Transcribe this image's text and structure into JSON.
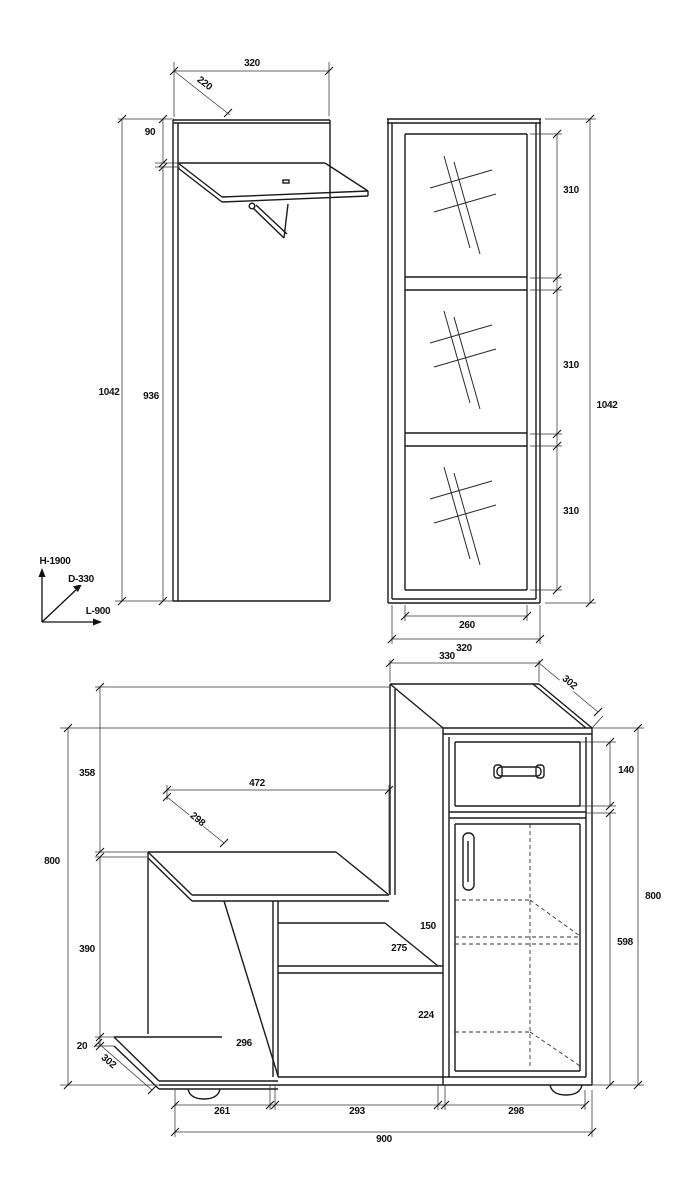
{
  "drawing": {
    "panel_view": {
      "width": "320",
      "depth": "220",
      "top_offset": "90",
      "total_height": "1042",
      "body_height": "936"
    },
    "wardrobe_view": {
      "mirror_top": "310",
      "mirror_mid": "310",
      "mirror_bottom": "310",
      "total_height": "1042",
      "inner_width": "260",
      "total_width": "320"
    },
    "axes": {
      "height": "H-1900",
      "depth": "D-330",
      "length": "L-900"
    },
    "cabinet_view": {
      "top_width": "330",
      "top_depth": "302",
      "drawer_height": "140",
      "right_height": "800",
      "door_height": "598",
      "left_upper": "358",
      "left_height": "800",
      "bench_width": "472",
      "bench_depth": "298",
      "left_lower": "390",
      "plinth_thickness": "20",
      "plinth_depth": "302",
      "side_panel_depth": "296",
      "shelf_clearance": "150",
      "shelf_depth": "275",
      "bottom_clearance": "224",
      "bay_left": "261",
      "bay_middle": "293",
      "bay_right": "298",
      "total_width": "900"
    }
  }
}
